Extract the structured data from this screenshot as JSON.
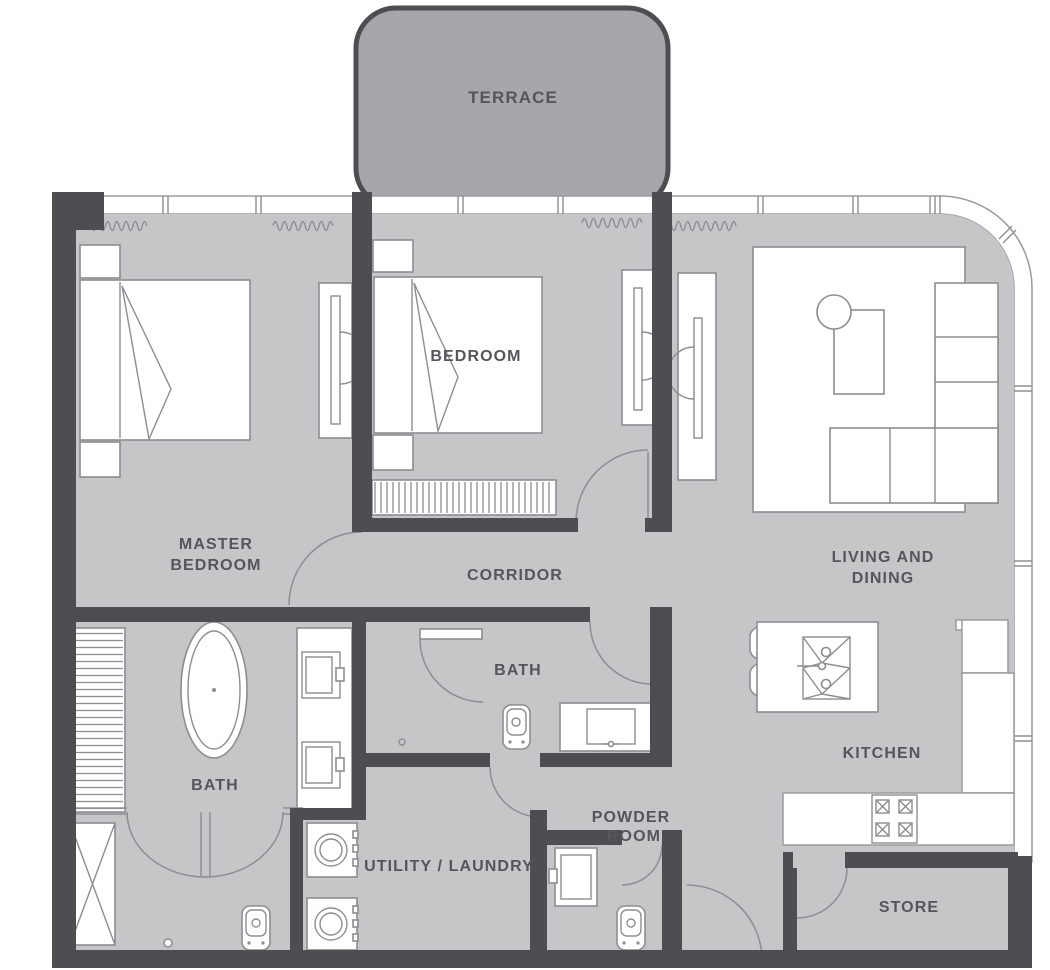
{
  "colors": {
    "background": "#ffffff",
    "floor": "#c6c6c9",
    "terrace": "#a6a6ab",
    "wall": "#4d4d52",
    "line": "#8d8d92",
    "outline": "#9a9aa0",
    "text": "#55555a"
  },
  "rooms": {
    "terrace": {
      "label": "TERRACE"
    },
    "master_bedroom": {
      "line1": "MASTER",
      "line2": "BEDROOM"
    },
    "bedroom": {
      "label": "BEDROOM"
    },
    "corridor": {
      "label": "CORRIDOR"
    },
    "living_dining": {
      "line1": "LIVING AND",
      "line2": "DINING"
    },
    "master_bath": {
      "label": "BATH"
    },
    "bath": {
      "label": "BATH"
    },
    "kitchen": {
      "label": "KITCHEN"
    },
    "utility": {
      "label": "UTILITY / LAUNDRY"
    },
    "powder": {
      "line1": "POWDER",
      "line2": "ROOM"
    },
    "store": {
      "label": "STORE"
    }
  }
}
